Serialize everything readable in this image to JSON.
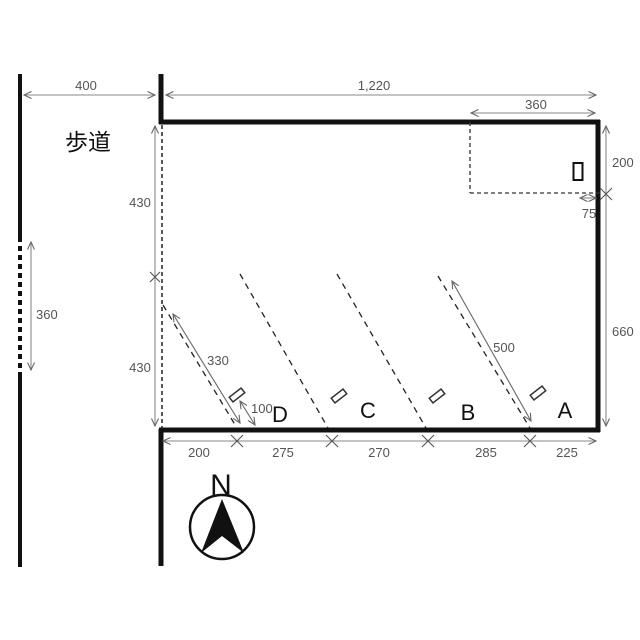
{
  "labels": {
    "sidewalk": "歩道",
    "north": "N",
    "stall_a": "A",
    "stall_b": "B",
    "stall_c": "C",
    "stall_d": "D"
  },
  "dimensions": {
    "sidewalk_width": "400",
    "frontage_total": "1,220",
    "notch_width": "360",
    "notch_depth": "200",
    "notch_offset": "75",
    "left_depth_upper": "430",
    "left_depth_lower": "430",
    "street_opening": "360",
    "right_depth": "660",
    "stall_d_length": "330",
    "stall_a_length": "500",
    "stop_setback": "100",
    "frontage_segments": [
      "200",
      "275",
      "270",
      "285",
      "225"
    ]
  },
  "colors": {
    "boundary": "#111111",
    "dimension_line": "#888888",
    "dimension_text": "#555555",
    "label_text": "#111111",
    "background": "#ffffff"
  }
}
